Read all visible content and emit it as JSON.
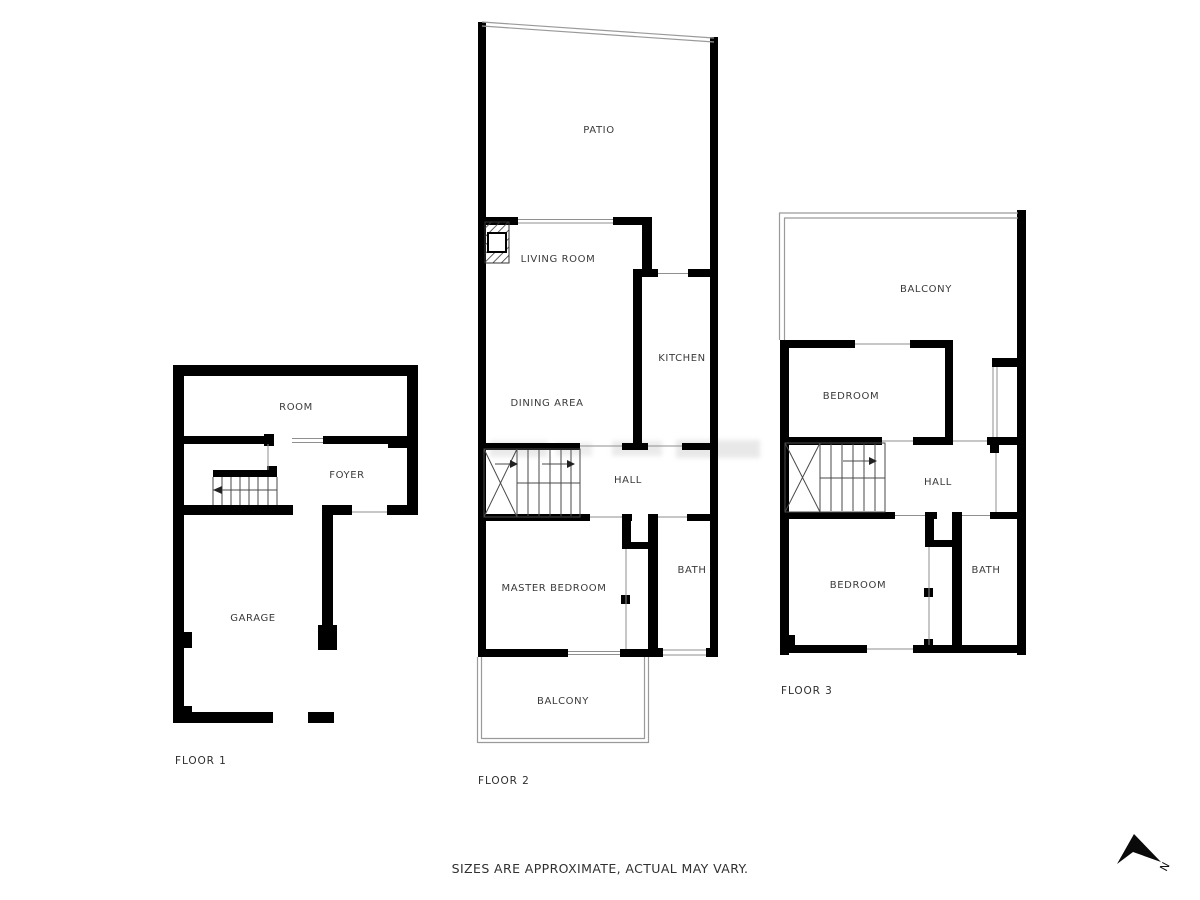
{
  "footer": {
    "disclaimer": "SIZES ARE APPROXIMATE, ACTUAL MAY VARY."
  },
  "compass": {
    "north_label": "N"
  },
  "floors": {
    "floor1": {
      "label": "FLOOR 1",
      "rooms": {
        "room": "ROOM",
        "foyer": "FOYER",
        "garage": "GARAGE"
      }
    },
    "floor2": {
      "label": "FLOOR 2",
      "rooms": {
        "patio": "PATIO",
        "living_room": "LIVING ROOM",
        "kitchen": "KITCHEN",
        "dining_area": "DINING AREA",
        "hall": "HALL",
        "master_bedroom": "MASTER BEDROOM",
        "bath": "BATH",
        "balcony": "BALCONY"
      }
    },
    "floor3": {
      "label": "FLOOR 3",
      "rooms": {
        "balcony": "BALCONY",
        "bedroom_upper": "BEDROOM",
        "hall": "HALL",
        "bedroom_lower": "BEDROOM",
        "bath": "BATH"
      }
    }
  },
  "colors": {
    "wall": "#000000",
    "room_label": "#3a3a3a",
    "thin_line": "#8f8f8f"
  }
}
